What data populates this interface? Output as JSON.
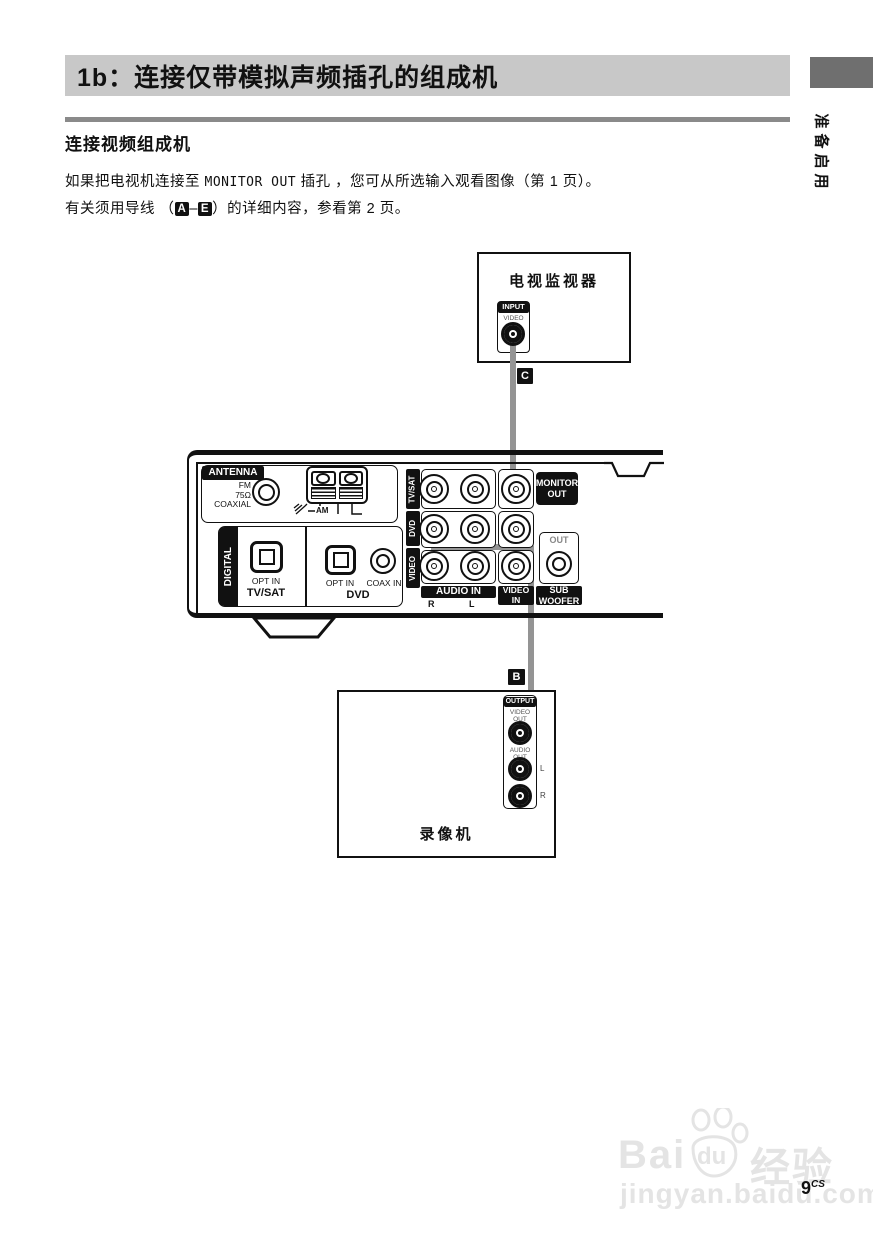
{
  "page": {
    "title": "1b：连接仅带模拟声频插孔的组成机",
    "side_tab": "准备启用",
    "section_heading": "连接视频组成机",
    "para1_pre": "如果把电视机连接至 ",
    "para1_mono": "MONITOR OUT",
    "para1_post": " 插孔 ，您可从所选输入观看图像（第 1 页）。",
    "para2_pre": "有关须用导线 （",
    "para2_a": "A",
    "para2_dash": "–",
    "para2_e": "E",
    "para2_post": "）的详细内容，参看第 2 页。",
    "page_number": "9",
    "page_suffix": "CS"
  },
  "tv": {
    "title": "电视监视器",
    "input": "INPUT",
    "video": "VIDEO"
  },
  "vcr": {
    "title": "录像机",
    "output": "OUTPUT",
    "video_out": "VIDEO OUT",
    "audio_out": "AUDIO OUT",
    "l": "L",
    "r": "R"
  },
  "cables": {
    "c": "C",
    "b": "B"
  },
  "receiver": {
    "antenna": "ANTENNA",
    "fm": "FM",
    "ohm": "75Ω",
    "coaxial": "COAXIAL",
    "am": "AM",
    "digital": "DIGITAL",
    "opt_in_tvsat": "OPT IN",
    "tvsat_label": "TV/SAT",
    "opt_in_dvd": "OPT IN",
    "coax_in": "COAX IN",
    "dvd_label": "DVD",
    "row_tvsat": "TV/SAT",
    "row_dvd": "DVD",
    "row_video": "VIDEO",
    "monitor_out": "MONITOR OUT",
    "audio_in": "AUDIO IN",
    "r": "R",
    "l": "L",
    "video_in": "VIDEO IN",
    "sub_out": "OUT",
    "sub_woofer": "SUB WOOFER"
  },
  "watermark": {
    "brand_a": "Bai",
    "brand_b": "du",
    "brand_suffix": "经验",
    "url": "jingyan.baidu.com"
  },
  "colors": {
    "title_bg": "#c8c8c8",
    "rule_gray": "#8a8a8a",
    "tab_gray": "#6f6f6f",
    "cable_gray": "#949494",
    "label_black": "#111111",
    "watermark_gray": "#e4e4e4"
  }
}
